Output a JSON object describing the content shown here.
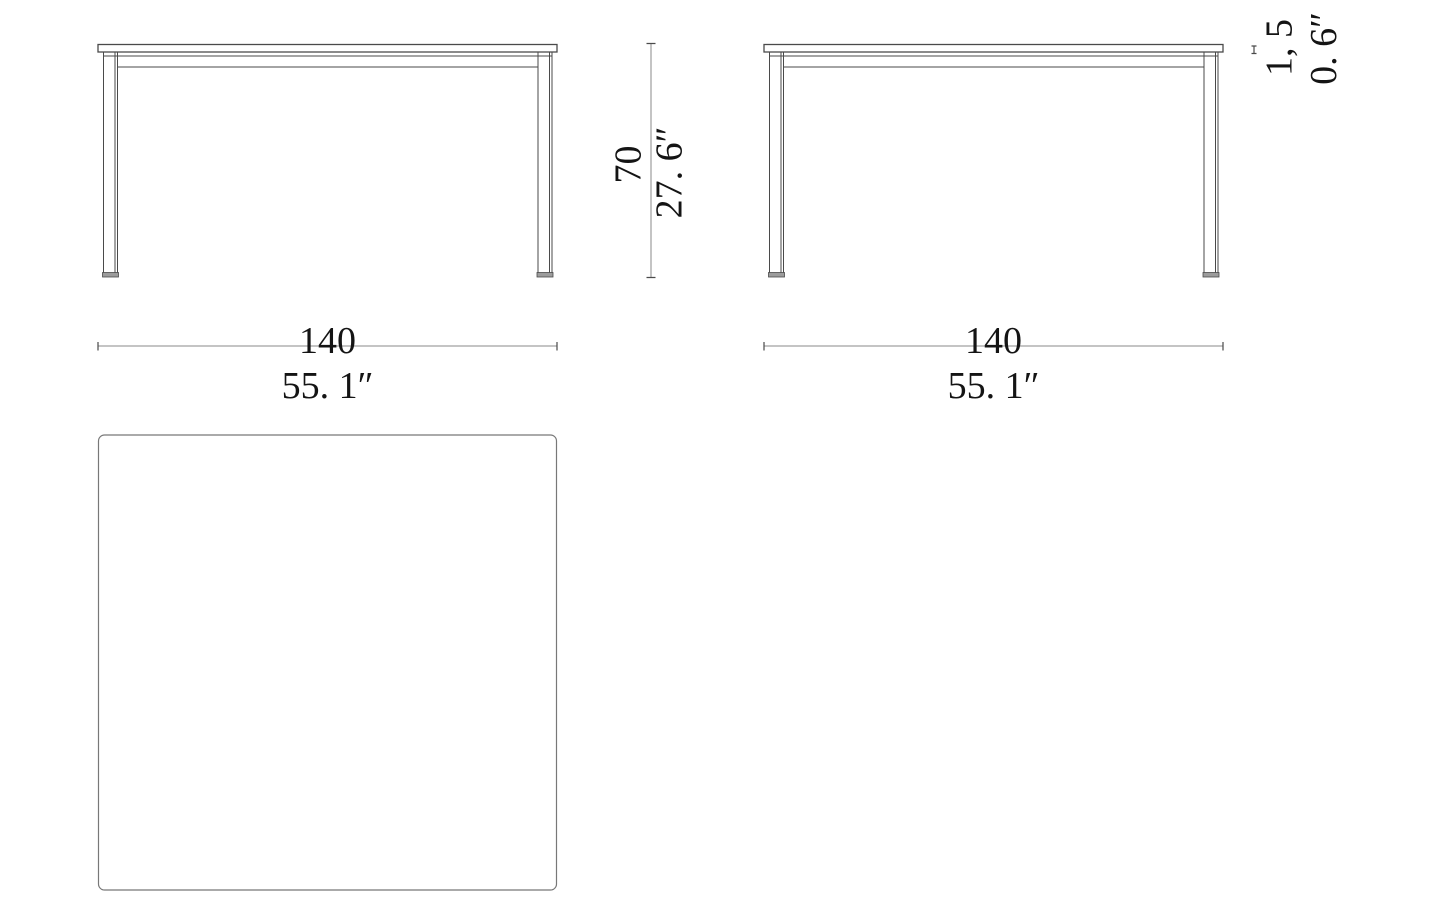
{
  "drawing": {
    "background": "#ffffff",
    "views": {
      "front": "front-elevation-of-table",
      "side": "side-elevation-of-table",
      "top": "top-plan-of-tabletop"
    },
    "dimensions": {
      "front_width": {
        "cm": "140",
        "inch": "55. 1″"
      },
      "side_depth": {
        "cm": "140",
        "inch": "55. 1″"
      },
      "height": {
        "cm": "70",
        "inch": "27. 6″"
      },
      "top_thickness": {
        "cm": "1, 5",
        "inch": "0. 6″"
      }
    },
    "colors": {
      "structure_line": "#4a4a4a",
      "dimension_line": "#8a8a8a",
      "top_view_line": "#787878",
      "text": "#141414",
      "foot_fill": "#9c9c9c"
    }
  }
}
